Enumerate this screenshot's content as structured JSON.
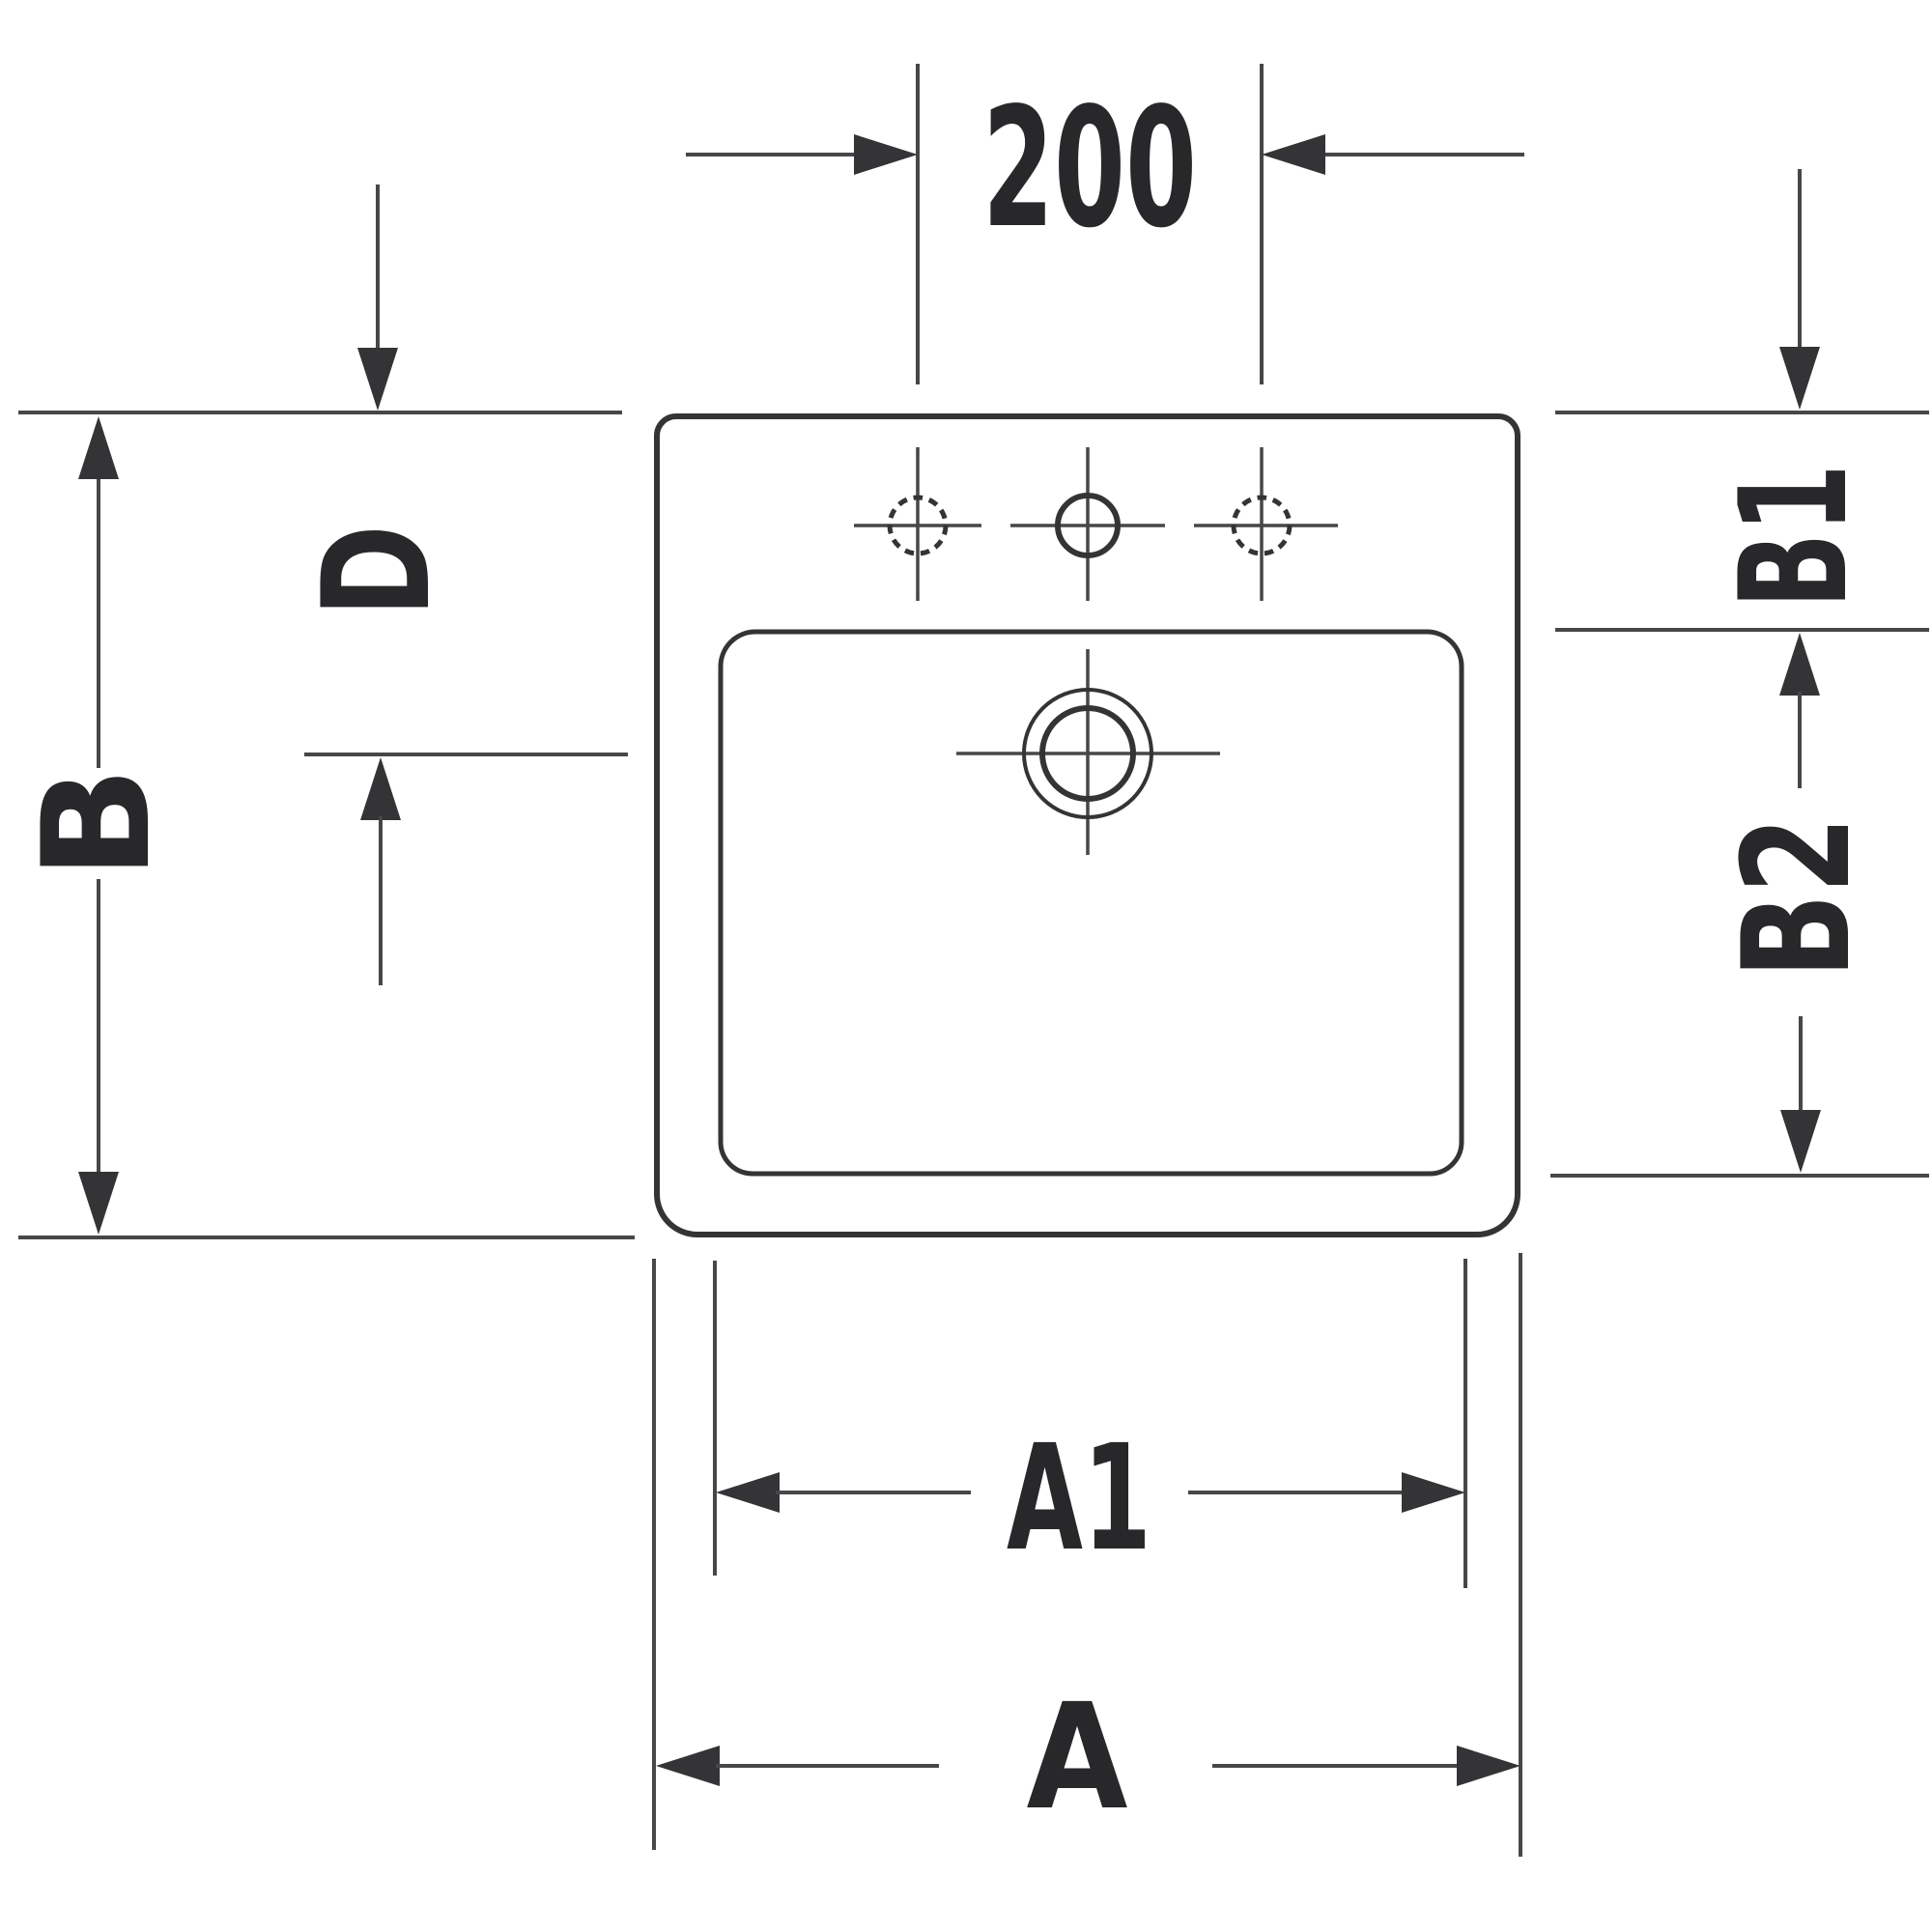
{
  "diagram": {
    "kind": "washbasin-plan-technical-drawing",
    "description": "Top view dimensional drawing of a square drop-in washbasin with three tap holes and a central drain",
    "colors": {
      "background": "#ffffff",
      "outline": "#343436",
      "thin_line": "#474749",
      "text": "#28282a"
    },
    "dimensions": {
      "tap_hole_spacing": {
        "label": "200"
      },
      "overall_width": {
        "label": "A"
      },
      "bowl_width": {
        "label": "A1"
      },
      "overall_depth": {
        "label": "B"
      },
      "rim_depth": {
        "label": "B1"
      },
      "bowl_depth": {
        "label": "B2"
      },
      "drain_setback": {
        "label": "D"
      }
    }
  }
}
